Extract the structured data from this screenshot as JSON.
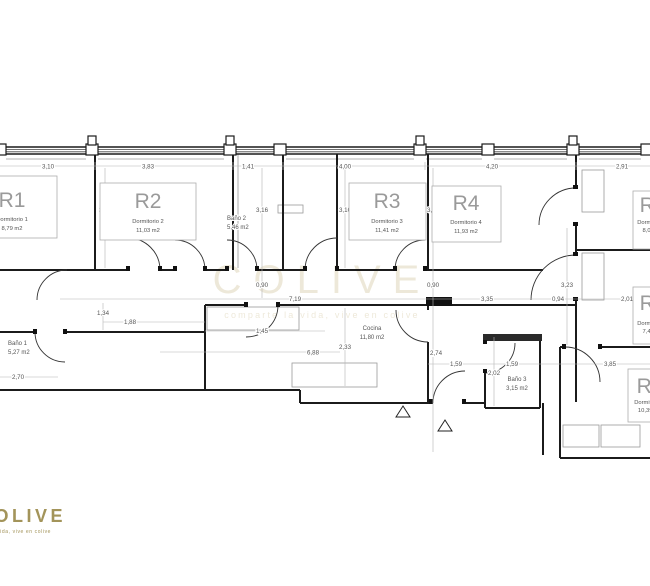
{
  "watermark": {
    "title": "COLIVE",
    "tagline": "comparte la vida, vive en colive"
  },
  "logo": {
    "title": "COLIVE",
    "tagline": "la vida, vive en colive"
  },
  "rooms": [
    {
      "id": "R1",
      "name": "Dormitorio 1",
      "area": "8,79 m2"
    },
    {
      "id": "R2",
      "name": "Dormitorio 2",
      "area": "11,03 m2"
    },
    {
      "id": "R3",
      "name": "Dormitorio 3",
      "area": "11,41 m2"
    },
    {
      "id": "R4",
      "name": "Dormitorio 4",
      "area": "11,93 m2"
    },
    {
      "id": "R5",
      "name": "Dormitorio 5",
      "area": "8,07 m2"
    },
    {
      "id": "R6",
      "name": "Dormitorio 6",
      "area": "7,43 m2"
    },
    {
      "id": "R7",
      "name": "Dormitorio 7",
      "area": "10,39 m2"
    }
  ],
  "spaces": [
    {
      "name": "Baño 1",
      "area": "5,27 m2"
    },
    {
      "name": "Baño 2",
      "area": "5,46 m2"
    },
    {
      "name": "Baño 3",
      "area": "3,15 m2"
    },
    {
      "name": "Cocina",
      "area": "11,80 m2"
    }
  ],
  "dims": [
    "3,10",
    "3,83",
    "1,41",
    "4,00",
    "4,20",
    "2,91",
    "3,10",
    "3,16",
    "3,10",
    "3,16",
    "0,90",
    "0,90",
    "7,19",
    "3,35",
    "0,94",
    "2,01",
    "3,23",
    "1,34",
    "1,88",
    "1,45",
    "6,88",
    "2,33",
    "2,70",
    "2,74",
    "1,59",
    "1,59",
    "2,02",
    "3,85"
  ],
  "colors": {
    "gold": "#a3945a",
    "watermark": "#e0d7bb",
    "wall": "#1b1b1b",
    "dim_text": "#555555",
    "room_label": "#9a9a9a"
  }
}
